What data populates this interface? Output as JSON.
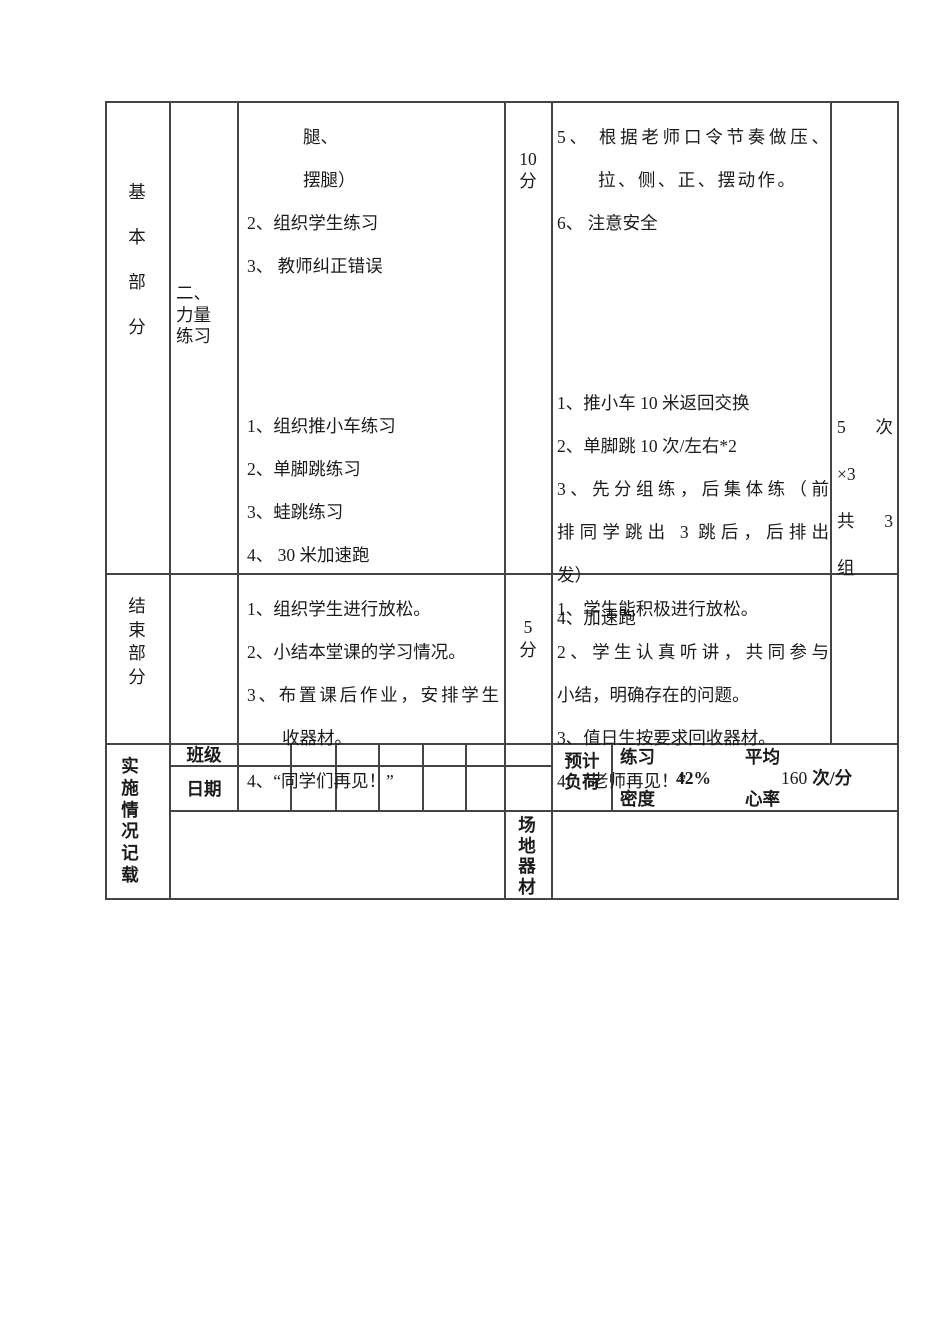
{
  "document": {
    "basic_section": {
      "section_label": "基\n本\n部\n分",
      "activity_label": "二、\n力量\n练习",
      "teaching_top": [
        "腿、",
        "摆腿）",
        "2、组织学生练习",
        "3、 教师纠正错误"
      ],
      "teaching_bottom": [
        "1、组织推小车练习",
        "2、单脚跳练习",
        "3、蛙跳练习",
        "4、 30 米加速跑"
      ],
      "time": "10\n分",
      "requirements_top": [
        "5、 根据老师口令节奏做压、",
        "拉、侧、正、摆动作。",
        "6、 注意安全"
      ],
      "requirements_bottom": [
        "1、推小车 10 米返回交换",
        "2、单脚跳 10 次/左右*2",
        "3、先分组练，后集体练（前",
        "排同学跳出 3 跳后，后排出",
        "发）",
        "4、加速跑"
      ],
      "load": [
        "5 次",
        "×3",
        "共 3",
        "组"
      ]
    },
    "end_section": {
      "section_label": "结\n束\n部\n分",
      "teaching": [
        "1、组织学生进行放松。",
        "2、小结本堂课的学习情况。",
        "3、布置课后作业，安排学生",
        "收器材。",
        "4、“同学们再见！”"
      ],
      "time": "5\n分",
      "requirements": [
        "1、学生能积极进行放松。",
        "2、学生认真听讲，共同参与",
        "小结，明确存在的问题。",
        "3、值日生按要求回收器材。",
        "4、“老师再见！”"
      ]
    },
    "record_section": {
      "section_label": "实\n施\n情\n况\n记\n载",
      "class_label": "班级",
      "date_label": "日期",
      "estimated_load_label": "预计\n负荷",
      "practice_density_label_top": "练习",
      "practice_density_label_bottom": "密度",
      "practice_density_value": "42%",
      "avg_heart_rate_label_top": "平均",
      "avg_heart_rate_label_bottom": "心率",
      "avg_heart_rate_value": "160",
      "avg_heart_rate_unit": "次/分",
      "venue_equipment_label": "场\n地\n器\n材"
    }
  }
}
